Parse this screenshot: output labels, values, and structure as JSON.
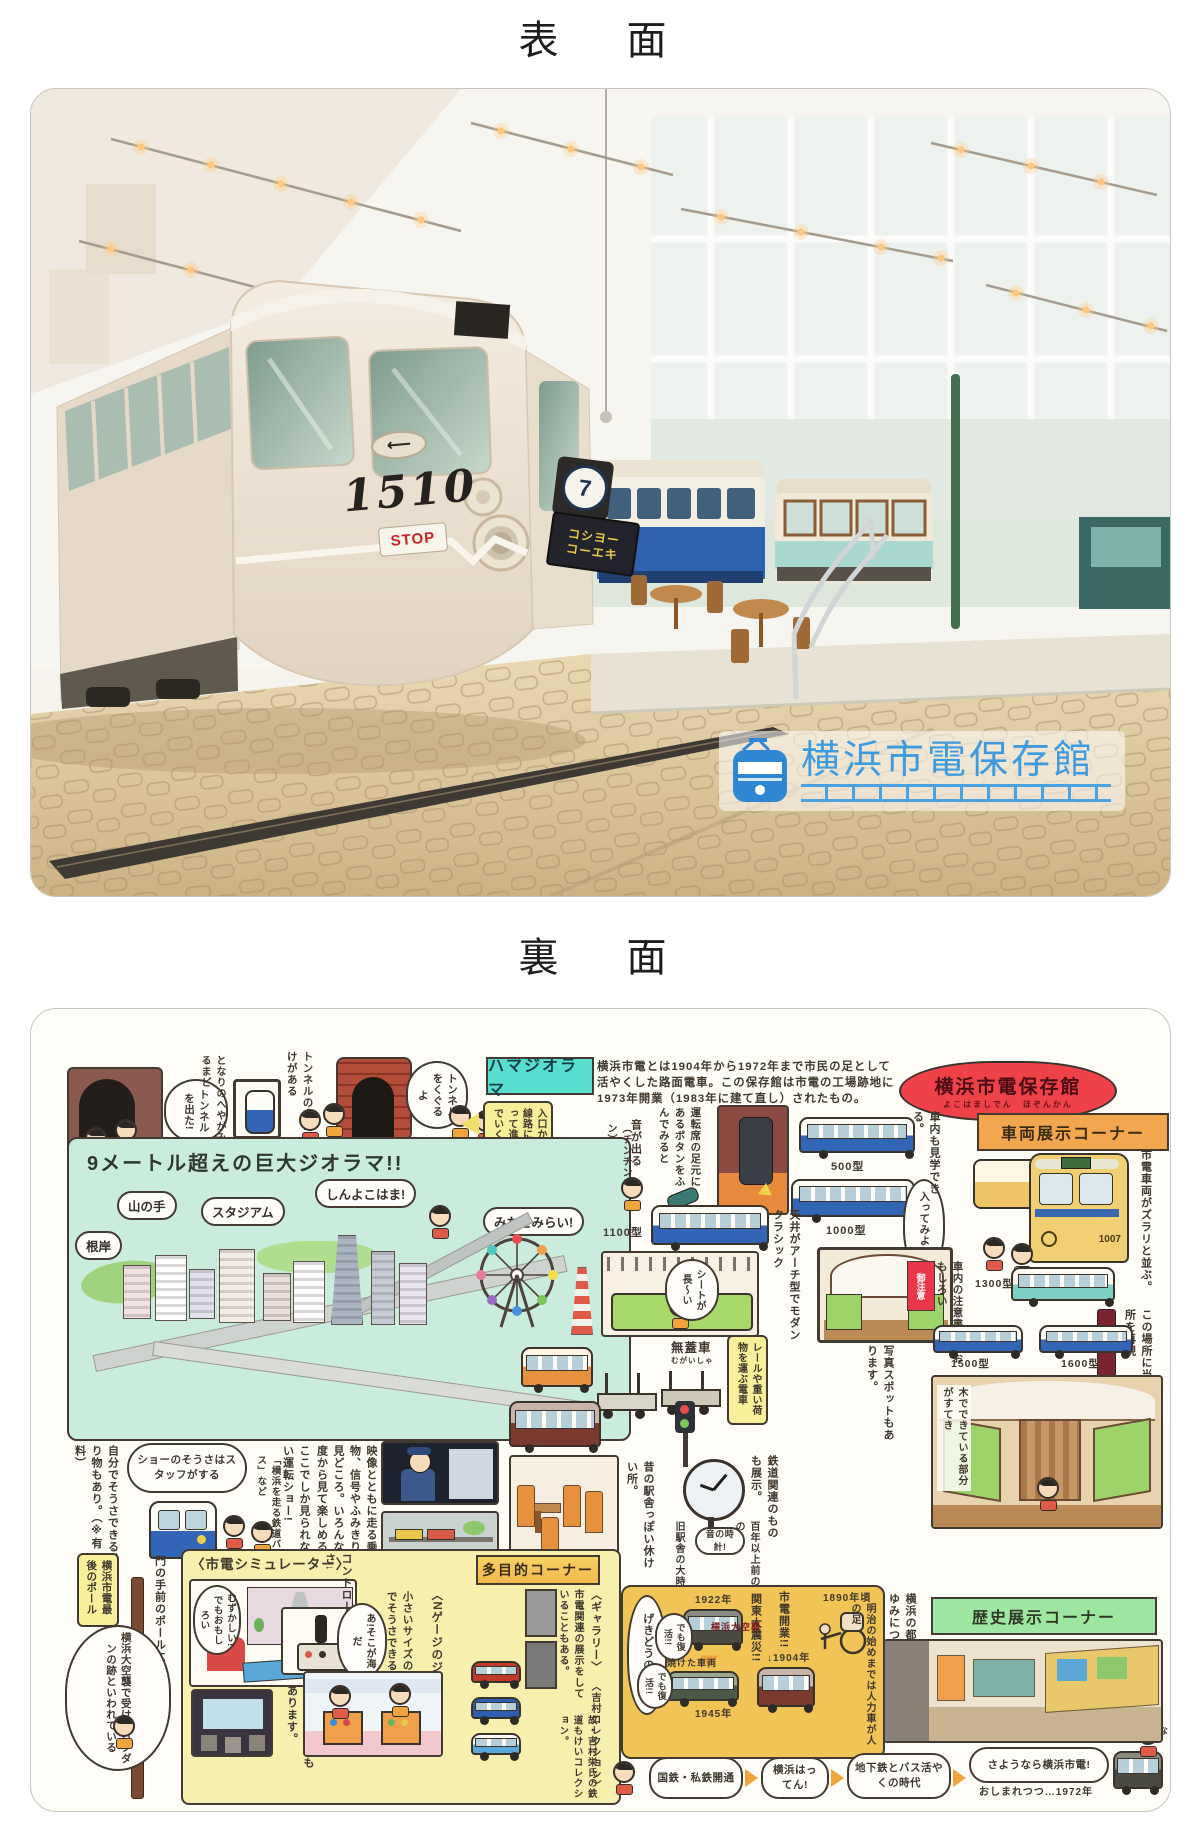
{
  "titles": {
    "front": "表　面",
    "back": "裏　面"
  },
  "photo": {
    "tram_number": "1510",
    "stop_sign": "STOP",
    "route_number": "7",
    "destination_line1": "コシヨー",
    "destination_line2": "コーエキ",
    "logo_title": "横浜市電保存館"
  },
  "back": {
    "badge_title": "横浜市電保存館",
    "badge_furigana": "よこはましでん　ほぞんかん",
    "intro": "横浜市電とは1904年から1972年まで市民の足として活やくした路面電車。この保存館は市電の工場跡地に1973年開業（1983年に建て直し）されたもの。",
    "tunnel": {
      "bubble_exit": "トンネルを出た!",
      "note_window": "となりのへやがみえるまど",
      "note_gimmick": "トンネルの中にもしかけがある",
      "bubble_through": "トンネルをくぐるよ",
      "sign": "ハマジオラマ",
      "note_entrance": "入口から線路にそって進んでいく。"
    },
    "diorama": {
      "headline": "9メートル超えの巨大ジオラマ!!",
      "negishi": "根岸",
      "yamanote": "山の手",
      "stadium": "スタジアム",
      "shinyokohama": "しんよこはま!",
      "minatomirai": "みなとみらい!",
      "note_view": "映像とともに走る乗り物、信号やふみきりも見どころ。いろんな角度から見て楽しめる。",
      "note_show": "ここでしか見られない運転ショー!",
      "note_show_sub": "「横浜を走る鉄道バス」など",
      "bubble_staff": "ショーのそうさはスタッフがする",
      "note_self": "自分でそうさできる乗り物もあり。（※有料）"
    },
    "vehicles": {
      "header": "車両展示コーナー",
      "note_lineup": "市電車両がズラリと並ぶ。",
      "note_inside": "車内も見学できる。",
      "bubble_enter": "入ってみよう!",
      "note_button": "運転席の足元にあるボタンをふんでみると",
      "note_sound": "音が出る",
      "sfx_bell": "（チンチンチン）",
      "t500": "500型",
      "t1000": "1000型",
      "t1100": "1100型",
      "t1300": "1300型",
      "t1500": "1500型",
      "t1600": "1600型",
      "car1007": "1007",
      "bubble_seat": "シートが長〜い",
      "note_ceiling": "天井がアーチ型でモダンクラシック",
      "notice_tag": "御注意",
      "note_notice": "車内の注意書きもおもしろい",
      "note_stop": "この場所に当時の停留所を再現",
      "note_wood": "木でできている部分がすてき",
      "mugaisha": "無蓋車",
      "mugaisha_kana": "むがいしゃ",
      "note_mugaisha": "レールや重い荷物を運ぶ電車",
      "note_photo": "写真スポットもあります。",
      "note_rest": "昔の駅舎っぽい休けい所。",
      "note_items": "鉄道関連のものも展示。",
      "note_clock": "旧駅舎の大時計",
      "note_clock_age": "百年以上前のもの",
      "bubble_clock": "音の時計!"
    },
    "corner": {
      "pole_tag": "横浜市電最後のポール",
      "note_pole": "門の手前のポールにも注目!",
      "bubble_bomb": "横浜大空襲で受けたバクダンの跡といわれている",
      "sim_header": "〈市電シミュレーター〉",
      "bubble_hard": "むずかしい!でもおもしろい",
      "note_controller": "コントローラーでそうさ↓",
      "note_theater": "〈シアター〉もあります。",
      "multi_header": "多目的コーナー",
      "ngauge": "〈Nゲージのジオラマ〉",
      "note_ngauge": "小さいサイズの乗り物を自分でそうさできる（※有料）",
      "bubble_sea": "あ!そこが海だ",
      "gallery": "〈ギャラリー〉",
      "note_gallery": "市電関連の展示をしていることもある。",
      "collection": "〈吉村コレクション〉",
      "note_collection": "故・吉村栄氏の鉄道もけいコレクション。"
    },
    "history": {
      "header": "歴史展示コーナー",
      "note_learn": "横浜の都市交通のあゆみについて学ぶ",
      "era": "げきどうの時代!",
      "y1890": "1890年頃",
      "note_rickshaw": "明治の始めまでは人力車が人の足",
      "open": "市電開業!!",
      "y1904": "↓1904年",
      "quake": "関東大震災!!",
      "y1922": "1922年",
      "revive1": "でも復活!!",
      "air_raid": "横浜大空襲",
      "burned": "焼けた車両",
      "y1945": "1945年",
      "revive2": "でも復活!!",
      "flow1": "国鉄・私鉄開通",
      "flow2": "横浜はってん!",
      "flow3": "地下鉄とバス活やくの時代",
      "goodbye": "さようなら横浜市電!",
      "goodbye_sub": "おしまれつつ…1972年",
      "bubble_ride": "のってみたかったな"
    }
  }
}
